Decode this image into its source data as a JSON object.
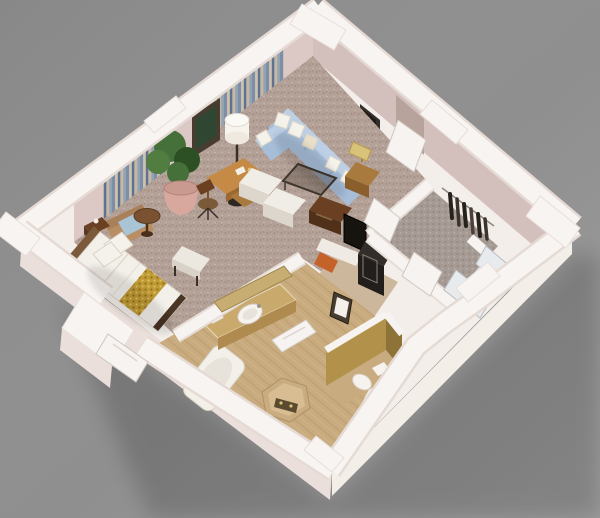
{
  "meta": {
    "alt": "Isometric 3D cutaway render of a studio hotel suite floor plan on a gray background",
    "description": "3D dollhouse-view floor plan: an open studio with a double bed with a gold patterned runner, foot bench, tan armchair, round side table, potted plant, framed art, drum floor lamp, wooden writing desk with chair, a light-blue L-shaped sectional sofa with white throw pillows, wire-frame coffee table, two white ottomans, lamp side table, TV and minibar nook, bathroom with gold-toned vanity and oval sink, bathtub, hexagonal shower platform, gold-walled toilet room, entry hall and closet with hanging clothes. White cut walls, mauve speckled carpet, soft shadow cast to the lower right."
  },
  "scene": {
    "type": "3d-floorplan-render",
    "rooms": [
      "studio bedroom-living room",
      "entry hall",
      "closet",
      "bathroom",
      "toilet room",
      "shower",
      "wet-bar nook"
    ],
    "furniture": [
      "double bed",
      "gold bed runner",
      "pillows",
      "foot bench",
      "nightstand",
      "armchair",
      "round side table",
      "potted plant",
      "framed picture",
      "floor lamp",
      "writing desk",
      "desk chair",
      "sectional sofa",
      "throw pillows",
      "coffee table",
      "ottoman x2",
      "luggage bench",
      "lamp side table",
      "flat-screen tv",
      "minibar cabinet",
      "framed sign",
      "vanity with sink",
      "gold mirror",
      "bathtub",
      "shower platform",
      "toilet",
      "hanging clothes",
      "swing doors",
      "mirrored closet doors"
    ]
  },
  "palette": {
    "bg": "#8f8f8f",
    "plate": "#f3eeea",
    "wallTop": "#f8f4f1",
    "wallInnerNW": "#dcc9c6",
    "wallInnerNE": "#d3c0bd",
    "wallOuterSW": "#eadfda",
    "wallOuterSE": "#f4eee9",
    "cornice": "#f1eae6",
    "recess": "#b7a29c",
    "carpet": "#b3a096",
    "hallCarpet": "#a69b94",
    "bathTile": "#c8ab7f",
    "nookTile": "#cdb79c",
    "goldWall": "#b2924a",
    "goldWallDark": "#8e7338",
    "sofa": "#a7bed9",
    "sofaLight": "#bccfe4",
    "pillow": "#f4f2ea",
    "pillowCream": "#e9dfc8",
    "duvet": "#f3f0ea",
    "runner": "#c09a34",
    "woodDesk": "#c58a45",
    "woodDeskDark": "#9c6930",
    "woodMid": "#a97a3e",
    "woodDark": "#6b3f22",
    "woodDarker": "#51301a",
    "headboard": "#7a5a3a",
    "footboard": "#4a3424",
    "tv": "#17130f",
    "minibar": "#332e2a",
    "minibarFront": "#221e1b",
    "white": "#f6f3ee",
    "benchTop": "#ece8e0",
    "benchFront": "#d8d2c8",
    "ottoman": "#f0ede6",
    "ottomanSide": "#dcd6cc",
    "chairTan": "#b98e62",
    "cushionBlue": "#a9c4d4",
    "tableRound": "#7a5232",
    "pot": "#d8a89f",
    "plant": "#45703a",
    "plantDark": "#2c5024",
    "plantLight": "#517d40",
    "lampShade": "#f7f4ee",
    "brass": "#d9c27a",
    "counter": "#c9a96c",
    "counterFront": "#b08b4f",
    "mirrorGold": "#c7ad72",
    "tub": "#f3efe9",
    "tubInner": "#e7e2da",
    "hexTile": "#c9ac80",
    "hexInner": "#d8bd92",
    "fixture": "#5a4a30",
    "door": "#f6f3f0",
    "mirrorDoor": "#e8ebee",
    "clothes": "#27211c",
    "vent": "#332e2a",
    "orange": "#c4622a",
    "glassTable": "#3f372e",
    "frame": "#473c30",
    "art": "#2e4632",
    "chairSeat": "#7a5a38"
  }
}
